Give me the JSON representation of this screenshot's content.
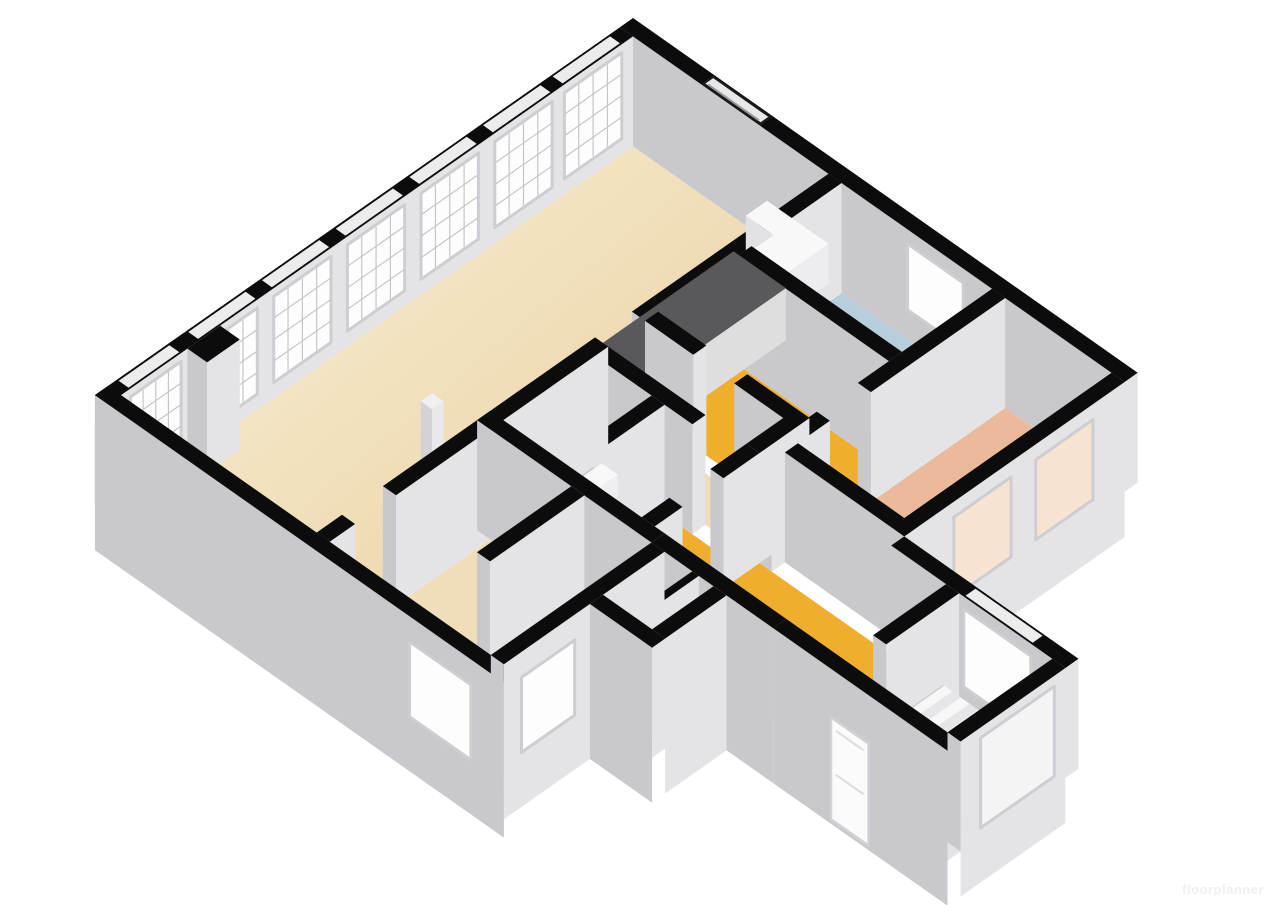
{
  "page": {
    "title": "3D floor plan render",
    "background": "#ffffff"
  },
  "watermark": {
    "text": "floorplanner"
  },
  "colors": {
    "wallTop": "#0c0c0c",
    "faceSW": "#c8c8cd",
    "faceSE": "#e4e4e7",
    "skirt": "#dfdfe2",
    "floorLivingLight": "#f6ead0",
    "floorLiving": "#eed9ae",
    "floorBeige": "#f0ddb9",
    "floorYellow": "#efae2e",
    "floorSalmon": "#eaba9b",
    "floorBlue": "#b7cedd",
    "floorStair": "#d9d3c2",
    "floorCell": "#ebebe8",
    "islandTop": "#59595c",
    "islandSide": "#cbcbce",
    "fixtureWhite": "#f8f8f8",
    "fixtureShade": "#e2e2e5",
    "stepShade": "#e6e6e9",
    "windowPane": "#fdfdfd",
    "windowFrame": "#cdcdd2",
    "glassTint": "#f6e3d2",
    "mullion": "#c6c6ca",
    "nicheSlot": "#e8e8e8",
    "nicheEdge": "#1a1a1a"
  },
  "rooms": {
    "living_kitchen": {
      "label": "living room / kitchen",
      "color": "floorLiving"
    },
    "bathroom": {
      "label": "bathroom",
      "color": "floorBlue"
    },
    "room_top": {
      "label": "room",
      "color": "floorYellow"
    },
    "hall": {
      "label": "hall",
      "color": "floorBeige"
    },
    "bedroom": {
      "label": "bedroom",
      "color": "floorSalmon"
    },
    "corridor": {
      "label": "corridor",
      "color": "floorYellow"
    },
    "stairwell": {
      "label": "stairwell",
      "color": "floorStair"
    },
    "storage_a": {
      "label": "storage",
      "color": "floorCell"
    },
    "storage_b": {
      "label": "storage",
      "color": "floorCell"
    },
    "side_room": {
      "label": "side room",
      "color": "floorYellow"
    },
    "room_bottom": {
      "label": "room",
      "color": "floorBeige"
    },
    "closet_a": {
      "label": "closet",
      "color": "floorCell"
    },
    "closet_b": {
      "label": "closet",
      "color": "floorCell"
    }
  },
  "fixtures": [
    "kitchen-island",
    "kitchen-counter",
    "column",
    "bathroom-vanity",
    "toilet",
    "staircase",
    "entry-door"
  ],
  "windows": {
    "left_facade_count": 7,
    "bedroom_facade_count": 2,
    "top_facade_niche": 1,
    "bathroom_window": 1,
    "corridor_window": 1,
    "stairwell_window": 1,
    "south_window": 1,
    "room_bottom_window": 1
  }
}
